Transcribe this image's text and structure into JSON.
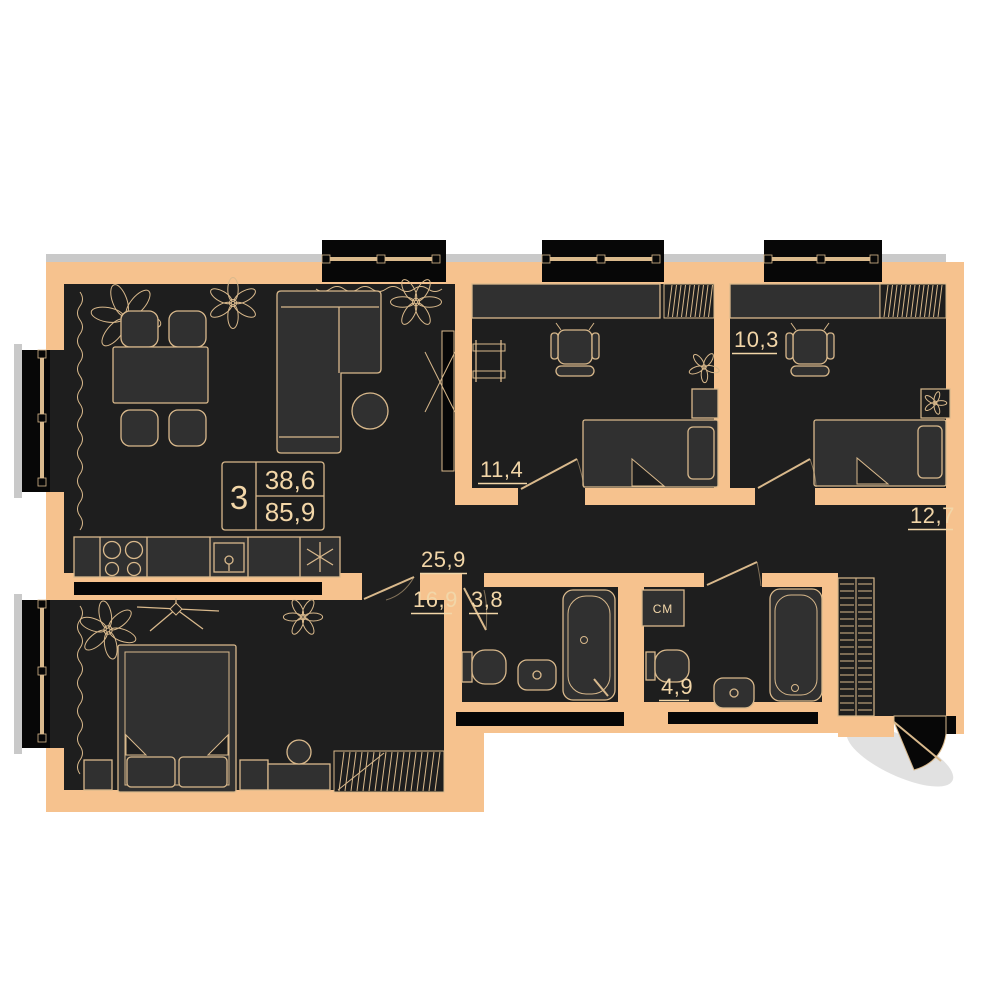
{
  "apartment_card": {
    "rooms_count": "3",
    "living_area": "38,6",
    "total_area": "85,9"
  },
  "room_labels": {
    "living_kitchen": "25,9",
    "master_bedroom": "16,9",
    "bedroom_2": "11,4",
    "bedroom_3": "10,3",
    "hallway": "12,7",
    "bathroom_1": "3,8",
    "bathroom_2": "4,9"
  },
  "appliance_labels": {
    "washing_machine": "СМ"
  },
  "icons": {
    "fridge": "snowflake-icon",
    "stove": "four-burner-icon",
    "plants": "plant-icon",
    "curtain": "wave-line-icon"
  },
  "colors": {
    "wall": "#f6c28e",
    "floor": "#1e1e1e",
    "furniture": "#303030",
    "line": "#d9b98c",
    "window": "#070707",
    "shadow": "#c9c9c9",
    "text": "#f2d6a8"
  }
}
